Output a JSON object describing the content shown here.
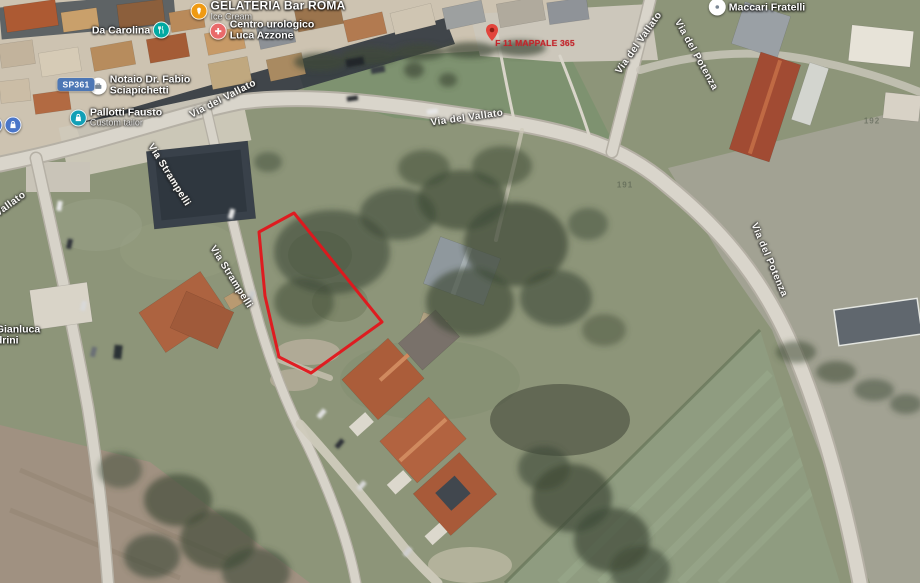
{
  "map": {
    "highlight_color": "#e3151b",
    "route_badge": "SP361",
    "cadastral_marker": "F 11 MAPPALE 365",
    "parcel_numbers": [
      "191",
      "192"
    ],
    "pois": [
      {
        "name": "Da Carolina",
        "icon": "restaurant-icon",
        "icon_color": "#00a9a2"
      },
      {
        "name": "GELATERIA Bar ROMA",
        "subtitle": "Ice Cream",
        "icon": "ice-cream-icon",
        "icon_color": "#ef9a13"
      },
      {
        "line1": "Centro urologico",
        "line2": "Luca Azzone",
        "icon": "medical-icon",
        "icon_color": "#e96a6a"
      },
      {
        "line1": "Notaio Dr. Fabio",
        "line2": "Sciapichetti",
        "icon": "briefcase-icon",
        "icon_color": "#ffffff"
      },
      {
        "name": "Pallotti Fausto",
        "subtitle": "Custom tailor",
        "icon": "shopping-icon",
        "icon_color": "#129fb6"
      },
      {
        "name": "Maccari Fratelli",
        "icon": "poi-icon",
        "icon_color": "#ffffff"
      },
      {
        "line1": "Gianluca",
        "line2": "drini"
      }
    ],
    "road_labels": [
      {
        "text": "Via del Vallato"
      },
      {
        "text": "Via del Vallato"
      },
      {
        "text": "Via del Vallato"
      },
      {
        "text": "Via del Potenza"
      },
      {
        "text": "Via del Potenza"
      },
      {
        "text": "Via Strampelli"
      },
      {
        "text": "Via Strampelli"
      },
      {
        "text": "l Vallato"
      }
    ]
  }
}
